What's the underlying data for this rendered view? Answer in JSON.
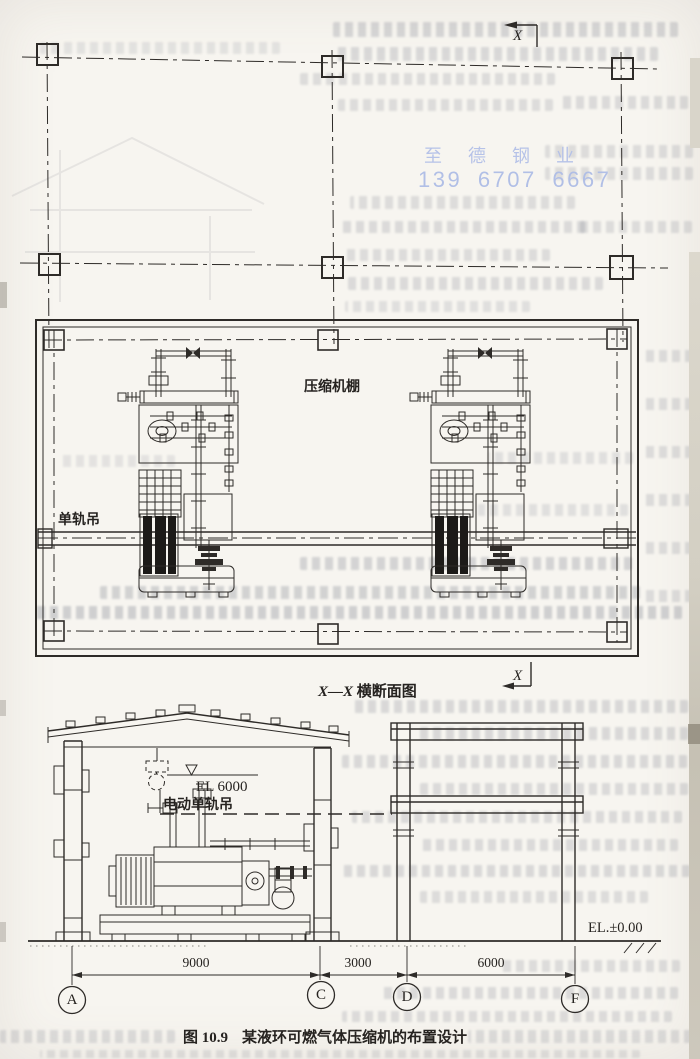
{
  "watermark": {
    "line1": "至德钢业",
    "line2": "139 6707 6667",
    "color": "#b3c0e8"
  },
  "plan": {
    "shed_label": "压缩机棚",
    "monorail_label": "单轨吊",
    "section_letter": "X"
  },
  "section": {
    "title_prefix": "X—X",
    "title_suffix": "横断面图",
    "hoist_level_label": "EL 6000",
    "hoist_label": "电动单轨吊",
    "ground_level_label": "EL.±0.00"
  },
  "dimensions": {
    "spans": [
      {
        "value": "9000"
      },
      {
        "value": "3000"
      },
      {
        "value": "6000"
      }
    ]
  },
  "grid": {
    "bubbles": [
      "A",
      "C",
      "D",
      "F"
    ]
  },
  "caption": {
    "figure": "图 10.9",
    "title": "某液环可燃气体压缩机的布置设计"
  },
  "colors": {
    "ink": "#2e2b28",
    "paper": "#f7f5f0",
    "watermark_blue": "#b3c0e8"
  }
}
